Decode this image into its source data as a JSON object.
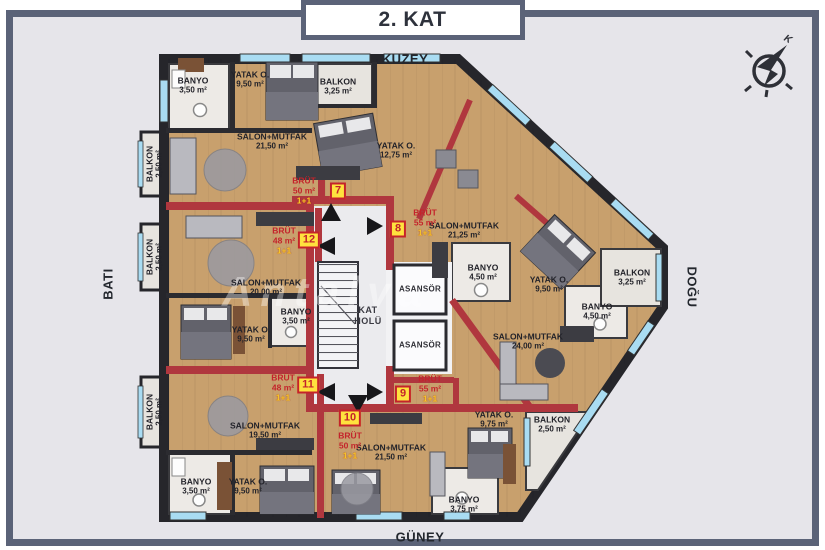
{
  "title": "2. KAT",
  "watermark": "Antalya",
  "directions": {
    "north": "KUZEY",
    "south": "GÜNEY",
    "west": "BATI",
    "east": "DOĞU",
    "compass": "K"
  },
  "core": {
    "hall_l1": "KAT",
    "hall_l2": "HOLÜ",
    "elevator1": "ASANSÖR",
    "elevator2": "ASANSÖR"
  },
  "rooms": [
    {
      "name": "BANYO",
      "area": "3,50 m²"
    },
    {
      "name": "YATAK O.",
      "area": "9,50 m²"
    },
    {
      "name": "BALKON",
      "area": "3,25 m²"
    },
    {
      "name": "SALON+MUTFAK",
      "area": "21,50 m²"
    },
    {
      "name": "YATAK O.",
      "area": "12,75 m²"
    },
    {
      "name": "BALKON",
      "area": "2,50 m²"
    },
    {
      "name": "BALKON",
      "area": "2,50 m²"
    },
    {
      "name": "BALKON",
      "area": "2,50 m²"
    },
    {
      "name": "SALON+MUTFAK",
      "area": "21,25 m²"
    },
    {
      "name": "BANYO",
      "area": "4,50 m²"
    },
    {
      "name": "YATAK O.",
      "area": "9,50 m²"
    },
    {
      "name": "BALKON",
      "area": "3,25 m²"
    },
    {
      "name": "BANYO",
      "area": "4,50 m²"
    },
    {
      "name": "SALON+MUTFAK",
      "area": "20,00 m²"
    },
    {
      "name": "BANYO",
      "area": "3,50 m²"
    },
    {
      "name": "YATAK O.",
      "area": "9,50 m²"
    },
    {
      "name": "SALON+MUTFAK",
      "area": "24,00 m²"
    },
    {
      "name": "YATAK O.",
      "area": "9,75 m²"
    },
    {
      "name": "BALKON",
      "area": "2,50 m²"
    },
    {
      "name": "SALON+MUTFAK",
      "area": "19,50 m²"
    },
    {
      "name": "BANYO",
      "area": "3,50 m²"
    },
    {
      "name": "YATAK O.",
      "area": "9,50 m²"
    },
    {
      "name": "SALON+MUTFAK",
      "area": "21,50 m²"
    },
    {
      "name": "BANYO",
      "area": "3,75 m²"
    }
  ],
  "units": [
    {
      "no": "7",
      "gross": "BRÜT",
      "area": "50 m²",
      "plan": "1+1"
    },
    {
      "no": "8",
      "gross": "BRÜT",
      "area": "55 m²",
      "plan": "1+1"
    },
    {
      "no": "9",
      "gross": "BRÜT",
      "area": "55 m²",
      "plan": "1+1"
    },
    {
      "no": "10",
      "gross": "BRÜT",
      "area": "50 m²",
      "plan": "1+1"
    },
    {
      "no": "11",
      "gross": "BRÜT",
      "area": "48 m²",
      "plan": "1+1"
    },
    {
      "no": "12",
      "gross": "BRÜT",
      "area": "48 m²",
      "plan": "1+1"
    }
  ],
  "colors": {
    "frame": "#5b6378",
    "background": "#e6e5ea",
    "outer_wall": "#26262b",
    "red_wall": "#b0373e",
    "window": "#a9dcf2",
    "wood_floor": "#c8a06d",
    "badge_bg": "#ffe23e",
    "badge_text": "#c4232b",
    "plan_text_yellow": "#ffd028"
  }
}
